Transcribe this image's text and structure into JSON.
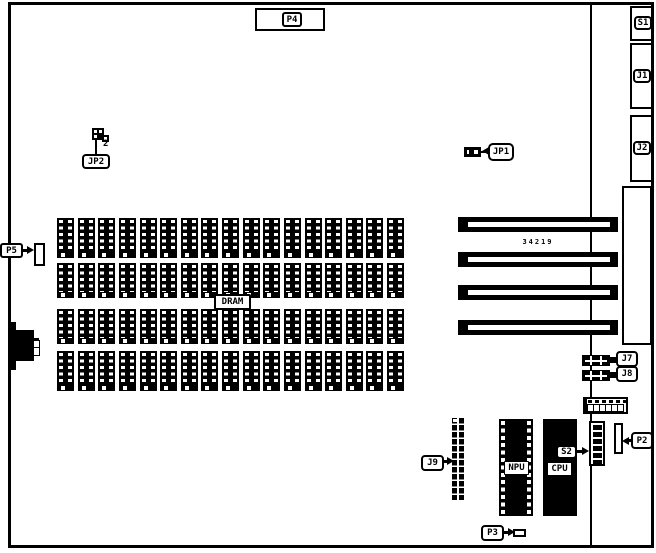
{
  "diagram": {
    "background": "#ffffff",
    "ink": "#000000"
  },
  "connectors": {
    "p4": "P4",
    "p5": "P5",
    "p2": "P2",
    "p3": "P3",
    "jp1": "JP1",
    "jp2": "JP2",
    "jp2_wire_count": "2",
    "s1": "S1",
    "s2": "S2",
    "j1": "J1",
    "j2": "J2",
    "j7": "J7",
    "j8": "J8",
    "j9": "J9"
  },
  "chips": {
    "dram_label": "DRAM",
    "npu_label": "NPU",
    "cpu_label": "CPU"
  },
  "memory_grid": {
    "rows": 4,
    "columns": 17
  },
  "expansion_slots": {
    "count": 4,
    "part_number": "34219"
  },
  "dip_header": {
    "top_pin_count": 6,
    "bottom_pin_count": 6
  },
  "s2_switch": {
    "segment_count": 6
  }
}
